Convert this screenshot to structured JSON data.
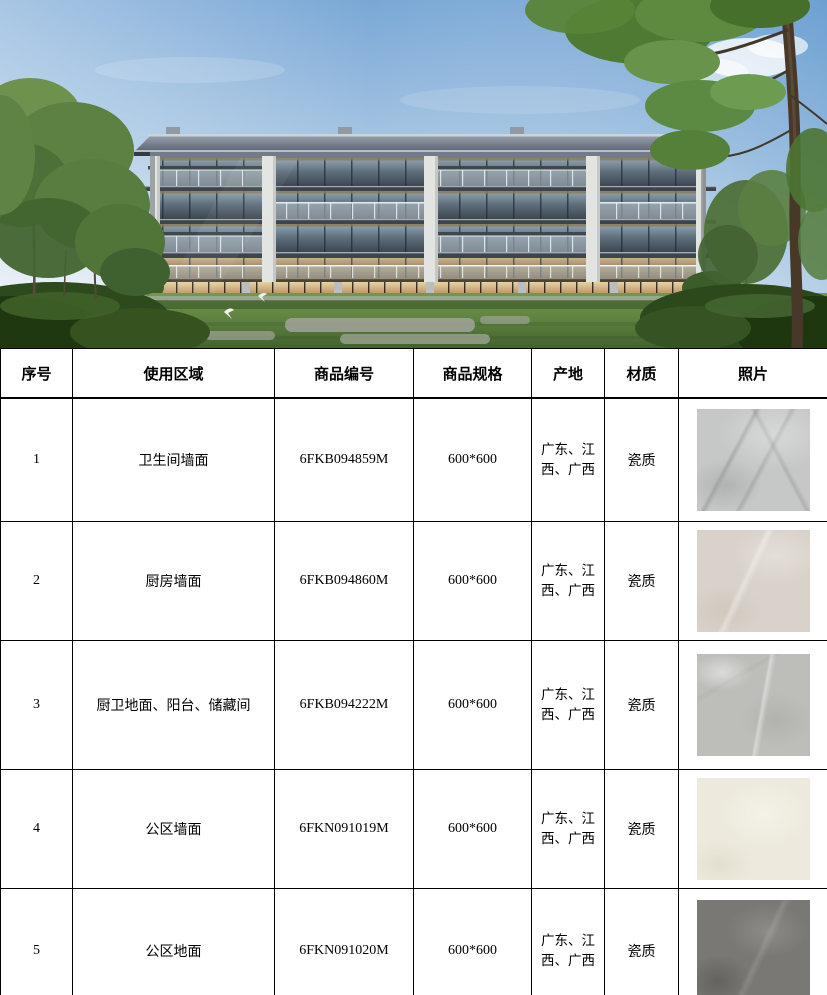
{
  "hero": {
    "name": "residential-building-rendering",
    "sky_top_color": "#79a7d6",
    "sky_horizon_color": "#e9f0f5",
    "grass_color": "#5d8140",
    "roof_color": "#646d79"
  },
  "table": {
    "headers": [
      "序号",
      "使用区域",
      "商品编号",
      "商品规格",
      "产地",
      "材质",
      "照片"
    ],
    "rows": [
      {
        "index": "1",
        "area": "卫生间墙面",
        "code": "6FKB094859M",
        "spec": "600*600",
        "origin": "广东、江西、广西",
        "material": "瓷质",
        "photo": "light-gray-marble-tile",
        "photo_color": "#c6c8c7",
        "photo_style": "background-color:#c6c8c7;background-image:radial-gradient(ellipse 70% 50% at 68% 25%,rgba(255,255,255,0.30),rgba(255,255,255,0) 70%),radial-gradient(ellipse 50% 40% at 25% 75%,rgba(150,154,152,0.45),rgba(150,154,152,0) 65%),linear-gradient(118deg,rgba(0,0,0,0) 34%,rgba(120,126,124,0.40) 36%,rgba(0,0,0,0) 39%,rgba(0,0,0,0) 55%,rgba(120,126,124,0.32) 57%,rgba(0,0,0,0) 60%),linear-gradient(62deg,rgba(0,0,0,0) 64%,rgba(130,136,134,0.35) 66%,rgba(0,0,0,0) 69%)"
      },
      {
        "index": "2",
        "area": "厨房墙面",
        "code": "6FKB094860M",
        "spec": "600*600",
        "origin": "广东、江西、广西",
        "material": "瓷质",
        "photo": "warm-beige-gray-tile",
        "photo_color": "#d9d2ca",
        "photo_style": "background-color:#d9d2ca;background-image:radial-gradient(ellipse 60% 45% at 70% 25%,rgba(255,255,255,0.28),rgba(255,255,255,0) 65%),linear-gradient(115deg,rgba(0,0,0,0) 42%,rgba(255,255,255,0.35) 45%,rgba(0,0,0,0) 49%),radial-gradient(ellipse 55% 45% at 25% 80%,rgba(196,186,176,0.40),rgba(196,186,176,0) 60%)"
      },
      {
        "index": "3",
        "area": "厨卫地面、阳台、储藏间",
        "code": "6FKB094222M",
        "spec": "600*600",
        "origin": "广东、江西、广西",
        "material": "瓷质",
        "photo": "gray-stone-marble-tile",
        "photo_color": "#bdbeba",
        "photo_style": "background-color:#bdbeba;background-image:radial-gradient(ellipse 45% 30% at 22% 18%,rgba(255,255,255,0.45),rgba(255,255,255,0) 60%),linear-gradient(100deg,rgba(0,0,0,0) 55%,rgba(255,255,255,0.40) 57%,rgba(0,0,0,0) 61%),radial-gradient(ellipse 55% 45% at 70% 65%,rgba(160,161,156,0.40),rgba(160,161,156,0) 60%),linear-gradient(150deg,rgba(0,0,0,0) 25%,rgba(170,171,166,0.35) 27%,rgba(0,0,0,0) 30%)"
      },
      {
        "index": "4",
        "area": "公区墙面",
        "code": "6FKN091019M",
        "spec": "600*600",
        "origin": "广东、江西、广西",
        "material": "瓷质",
        "photo": "cream-offwhite-tile",
        "photo_color": "#edeadd",
        "photo_style": "background-color:#edeadd;background-image:radial-gradient(ellipse 60% 50% at 60% 35%,rgba(255,255,255,0.35),rgba(255,255,255,0) 65%),radial-gradient(ellipse 50% 40% at 20% 85%,rgba(216,211,194,0.50),rgba(216,211,194,0) 60%)"
      },
      {
        "index": "5",
        "area": "公区地面",
        "code": "6FKN091020M",
        "spec": "600*600",
        "origin": "广东、江西、广西",
        "material": "瓷质",
        "photo": "dark-gray-slate-tile",
        "photo_color": "#7a7874",
        "photo_style": "background-color:#7a7874;background-image:radial-gradient(ellipse 60% 45% at 62% 30%,rgba(255,255,255,0.14),rgba(255,255,255,0) 60%),radial-gradient(ellipse 50% 45% at 18% 80%,rgba(0,0,0,0.18),rgba(0,0,0,0) 60%),linear-gradient(115deg,rgba(0,0,0,0) 52%,rgba(255,255,255,0.12) 55%,rgba(0,0,0,0) 59%)"
      }
    ]
  }
}
